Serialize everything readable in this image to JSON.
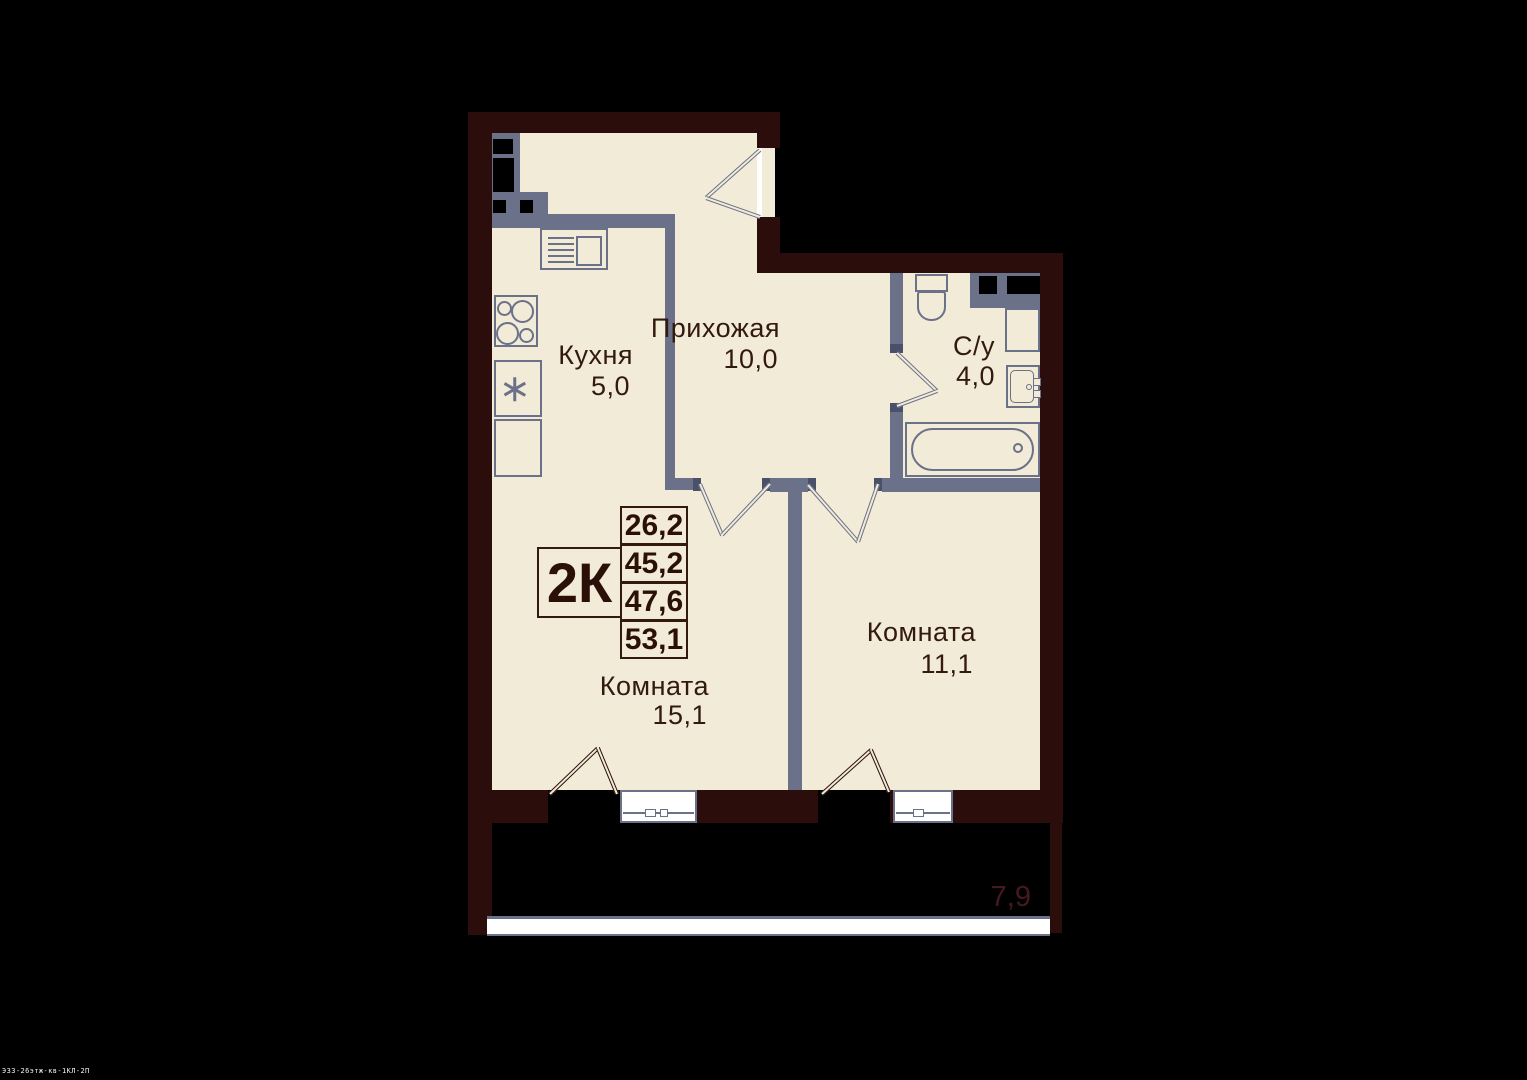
{
  "plan": {
    "unit_label": "2К",
    "area_values": [
      "26,2",
      "45,2",
      "47,6",
      "53,1"
    ],
    "rooms": {
      "kitchen": {
        "name": "Кухня",
        "area": "5,0"
      },
      "hallway": {
        "name": "Прихожая",
        "area": "10,0"
      },
      "bathroom": {
        "name": "С/у",
        "area": "4,0"
      },
      "living1": {
        "name": "Комната",
        "area": "15,1"
      },
      "living2": {
        "name": "Комната",
        "area": "11,1"
      },
      "balcony": {
        "area": "7,9"
      }
    },
    "watermark": "ЭЗЗ-26этж-кв-1КЛ-2П",
    "colors": {
      "floor": "#f2ebd8",
      "outer_wall": "#2b0e0b",
      "inner_wall": "#6a7189",
      "label_text": "#331a0f",
      "balcony_area_text": "#461920"
    }
  }
}
